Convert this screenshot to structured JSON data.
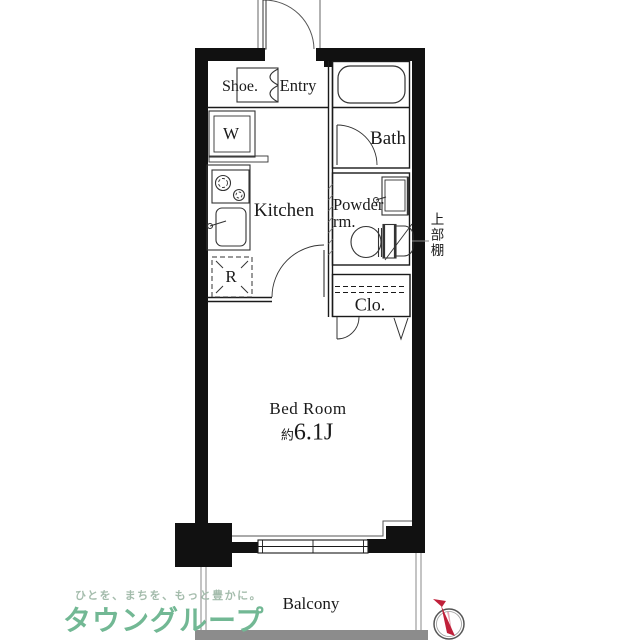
{
  "plan": {
    "shoe_label": "Shoe.",
    "entry_label": "Entry",
    "washer_label": "W",
    "bath_label": "Bath",
    "kitchen_label": "Kitchen",
    "powder_label_line1": "Powder",
    "powder_label_line2": "rm.",
    "fridge_label": "R",
    "upper_shelf_label": "上部棚",
    "closet_label": "Clo.",
    "bedroom_label": "Bed Room",
    "bedroom_area_prefix": "約",
    "bedroom_area_value": "6.1J",
    "balcony_label": "Balcony"
  },
  "branding": {
    "tagline": "ひとを、まちを、もっと豊かに。",
    "company_name": "タウングループ",
    "logo_badge_text": "TOWN GROUP",
    "brand_green": "#72b894",
    "tagline_green": "#a4bcac",
    "badge_green": "#8cc7a6"
  },
  "compass": {
    "type": "north-arrow",
    "needle_color": "#c0203a"
  }
}
